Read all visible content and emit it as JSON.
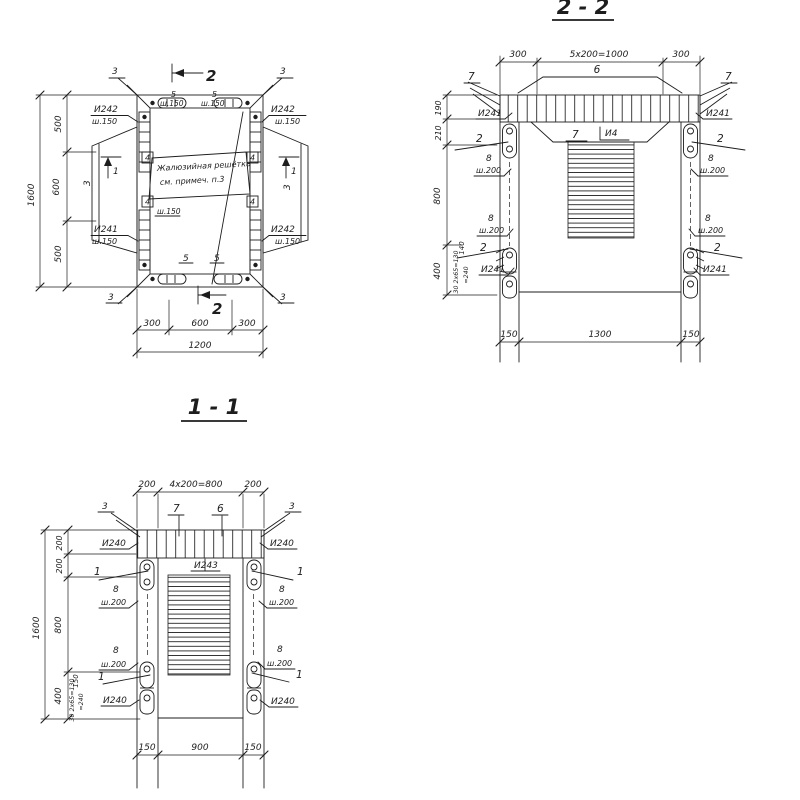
{
  "ink": "#1d1d1d",
  "paper": "#ffffff",
  "plan": {
    "cut": "2",
    "item1": "1",
    "item3": "3",
    "item4": "4",
    "item5": "5",
    "i241": "И241",
    "i242": "И242",
    "sh150": "ш.150",
    "note1": "Жалюзийная решётка",
    "note2": "см. примеч. п.3",
    "d1600": "1600",
    "d500": "500",
    "d600": "600",
    "d300": "300",
    "d1200": "1200"
  },
  "sec22": {
    "title": "2 - 2",
    "d300": "300",
    "drun": "5x200=1000",
    "item2": "2",
    "item6": "6",
    "item7": "7",
    "item8": "8",
    "i4": "И4",
    "i241": "И241",
    "sh200": "ш.200",
    "d190": "190",
    "d210": "210",
    "d800": "800",
    "d400": "400",
    "d140": "140",
    "dsmall1": "30 2x65=130",
    "dsmall2": "=240",
    "d150": "150",
    "d1300": "1300"
  },
  "sec11": {
    "title": "1 - 1",
    "d200": "200",
    "drun": "4x200=800",
    "item1": "1",
    "item3": "3",
    "item6": "6",
    "item7": "7",
    "item8": "8",
    "i240": "И240",
    "i243": "И243",
    "sh200": "ш.200",
    "d1600": "1600",
    "d800": "800",
    "d400": "400",
    "d150": "150",
    "d900": "900",
    "dsmall1": "30 2x65=130",
    "dsmall2": "=240"
  }
}
